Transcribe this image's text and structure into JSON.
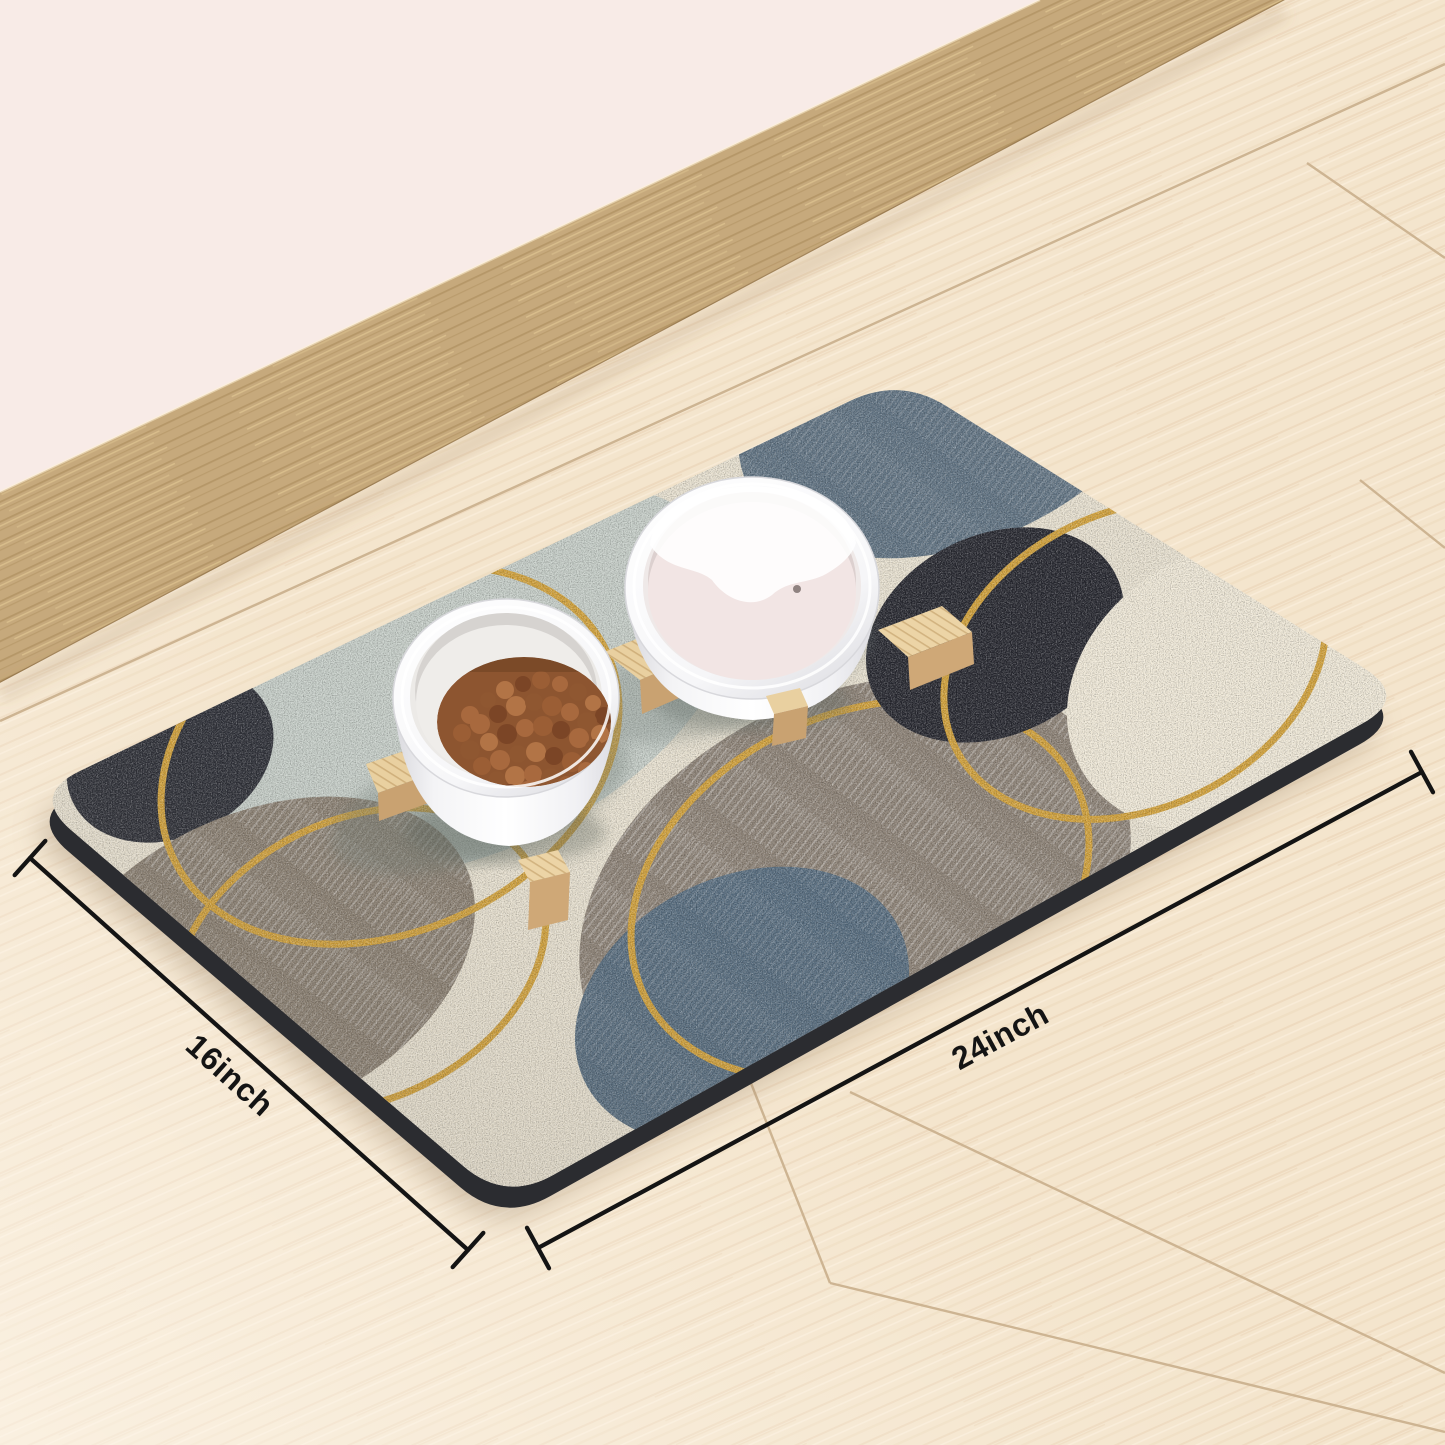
{
  "annotations": {
    "width_label": "16inch",
    "length_label": "24inch"
  },
  "palette": {
    "wall_pink": "#f8ebe7",
    "baseboard_wood": "#c6a97c",
    "floor_wood": "#f4e5cd",
    "floor_seam": "#cdb492",
    "mat_base": "#e9e2d1",
    "mat_edge": "#2b2c30",
    "circle_sage": "#c6cec8",
    "circle_slate_top": "#5d7080",
    "circle_navy_center": "#25262e",
    "circle_navy_left": "#2c2e36",
    "circle_gray_center": "#8b8074",
    "circle_gray_bottom_left": "#897e70",
    "circle_blue_bottom": "#546a7d",
    "circle_cream_right": "#f0e9d8",
    "ring_gold": "#d2a139",
    "bowl_white": "#ffffff",
    "water_pink": "#f2e5e4",
    "kibble_brown": "#8d5530",
    "stand_wood": "#e6cb9c",
    "dimension_ink": "#141414"
  }
}
